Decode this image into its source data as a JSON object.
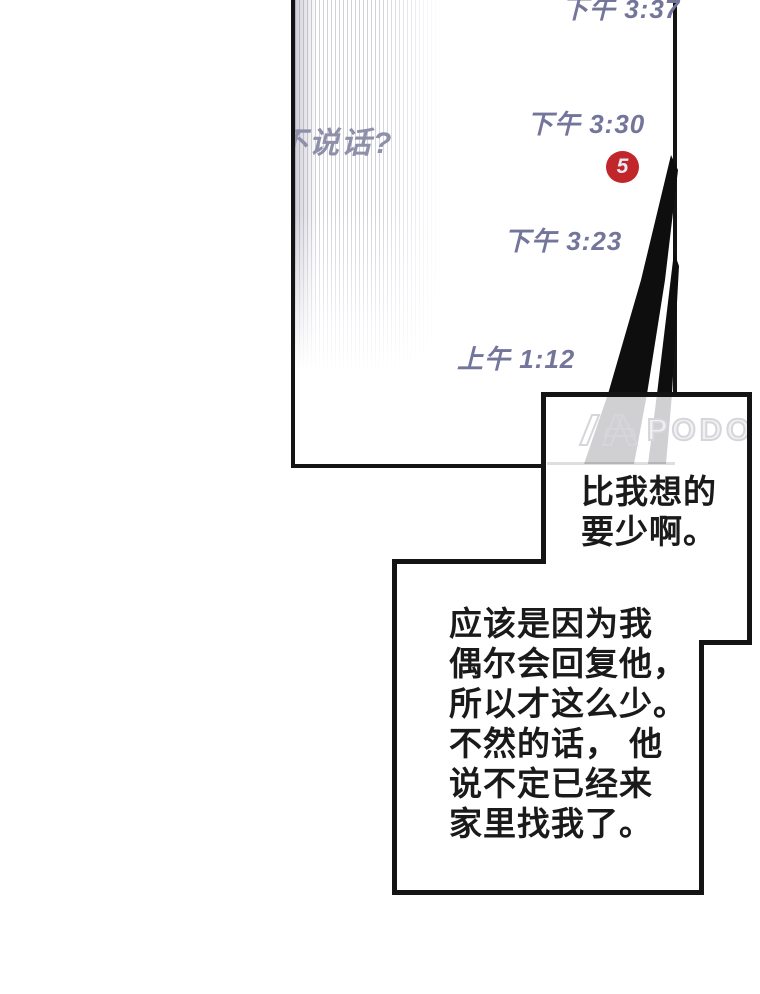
{
  "page": {
    "type": "webtoon-panel",
    "colors": {
      "badge_red": "#c1262b",
      "timestamp_indigo": "#73759a",
      "stripe_black": "#0e0e0e",
      "stripe_faded_gray": "#d0d0d3",
      "watermark_gray": "#d6d6da"
    }
  },
  "chat_panel": {
    "partial_message": "不说话?",
    "timestamps": [
      "下午 3:37",
      "下午 3:30",
      "下午 3:23",
      "上午 1:12"
    ],
    "unread_badge": {
      "count": "5"
    }
  },
  "watermark": {
    "text": "PODO",
    "logo": "podo-logo"
  },
  "speech_bubbles": [
    {
      "lines": [
        "比我想的",
        "要少啊。"
      ]
    },
    {
      "lines": [
        "应该是因为我",
        "偶尔会回复他，",
        "所以才这么少。",
        "不然的话， 他",
        "说不定已经来",
        "家里找我了。"
      ]
    }
  ]
}
